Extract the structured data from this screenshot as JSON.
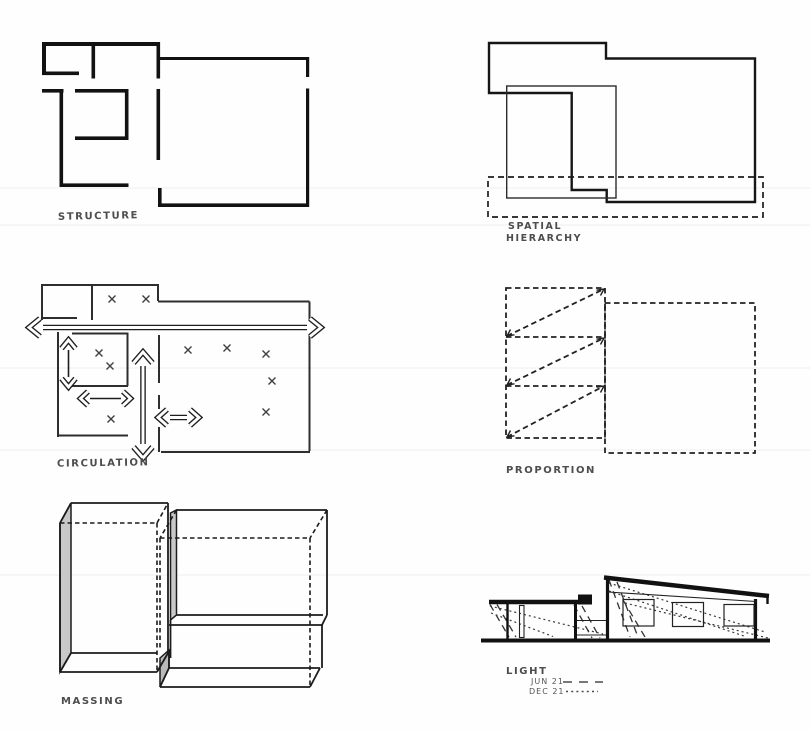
{
  "sheet": {
    "description": "Architectural concept analysis diagrams, hand-drawn, six panels",
    "colors": {
      "ink": "#161616",
      "pencil_label": "#4d4d4d",
      "shade": "#c8c8c8",
      "paper": "#fefefe"
    }
  },
  "panels": {
    "structure": {
      "label": "STRUCTURE"
    },
    "spatial_hierarchy": {
      "label_line1": "SPATIAL",
      "label_line2": "HIERARCHY"
    },
    "circulation": {
      "label": "CIRCULATION"
    },
    "proportion": {
      "label": "PROPORTION"
    },
    "massing": {
      "label": "MASSING"
    },
    "light": {
      "label": "LIGHT",
      "legend": [
        {
          "label": "JUN 21",
          "style": "long-dash"
        },
        {
          "label": "DEC 21",
          "style": "dotted"
        }
      ]
    }
  }
}
